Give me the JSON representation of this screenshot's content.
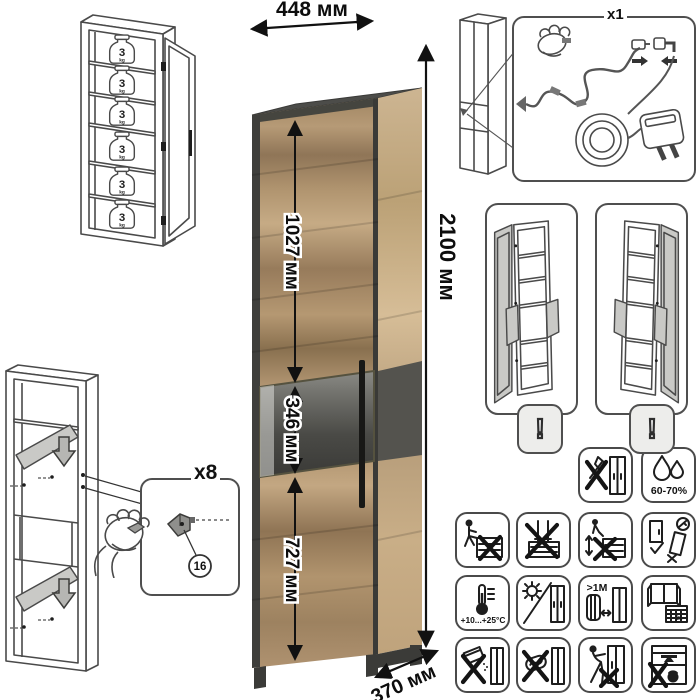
{
  "dimensions": {
    "width": "448 мм",
    "upper_door": "1027 мм",
    "display_section": "346 мм",
    "lower_door": "727 мм",
    "height": "2100 мм",
    "depth": "370 мм"
  },
  "shelf_load": {
    "value": "3",
    "unit": "kg",
    "shelf_count": 6
  },
  "led_kit": {
    "quantity": "x1"
  },
  "assembly": {
    "fastener_quantity": "x8",
    "part_number": "16"
  },
  "door_variants": {
    "warning_mark": "!"
  },
  "care": {
    "humidity": "60-70%",
    "temperature": "+10...+25°C",
    "heater_distance": ">1M",
    "acclimatize_days": "21"
  },
  "care_icon_names": [
    "no-sharp-tools",
    "humidity-range",
    "no-sitting",
    "no-standing",
    "no-climbing",
    "adjust-doors",
    "temperature-range",
    "no-direct-sunlight",
    "keep-distance-from-heater",
    "ventilate-room",
    "no-abrasives",
    "no-scrubbing",
    "no-dragging",
    "no-overloading"
  ],
  "colors": {
    "wood_light": "#c2a780",
    "wood_dark": "#8d7254",
    "graphite": "#4b4b48",
    "line": "#4a4a4a"
  }
}
